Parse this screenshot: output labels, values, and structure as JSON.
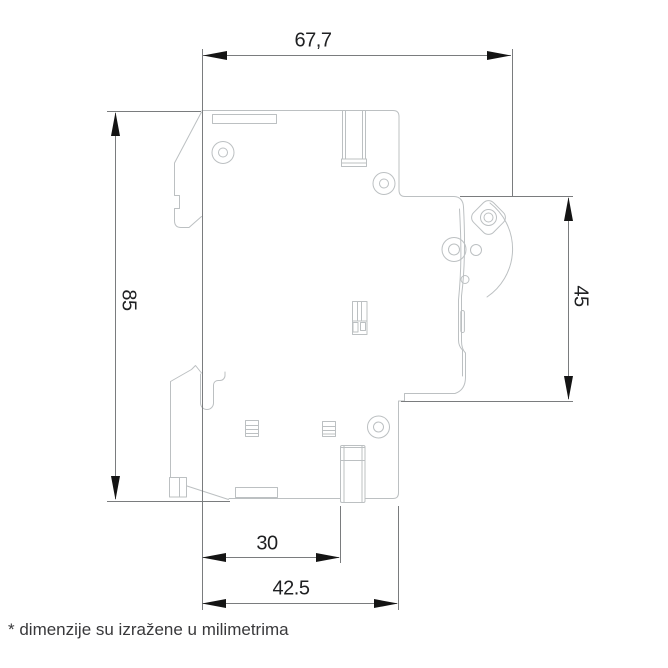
{
  "diagram": {
    "type": "technical-dimension-drawing",
    "subject": "circuit-breaker-side-view",
    "footnote": "* dimenzije su izražene u milimetrima",
    "dimensions": {
      "top_width": {
        "label": "67,7",
        "orientation": "horizontal"
      },
      "left_height": {
        "label": "85",
        "orientation": "vertical"
      },
      "right_height": {
        "label": "45",
        "orientation": "vertical"
      },
      "bottom_inner_width": {
        "label": "30",
        "orientation": "horizontal"
      },
      "bottom_outer_width": {
        "label": "42.5",
        "orientation": "horizontal"
      }
    },
    "colors": {
      "outline": "#bcc0c2",
      "dimension_lines": "#7a7c7e",
      "arrowheads": "#141414",
      "text": "#1f2022"
    }
  }
}
